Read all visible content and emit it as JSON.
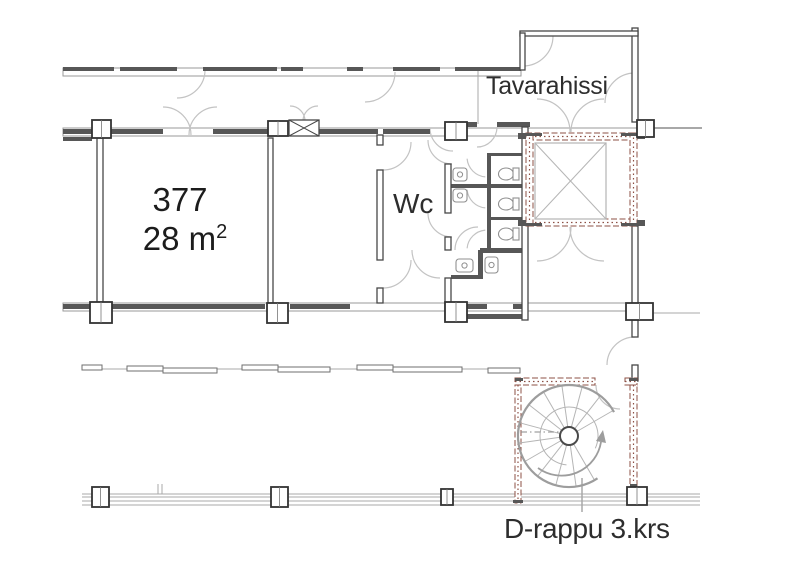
{
  "labels": {
    "tavarahissi": "Tavarahissi",
    "room_number": "377",
    "area_value": "28 m",
    "area_sup": "2",
    "wc": "Wc",
    "stair": "D-rappu 3.krs"
  },
  "colors": {
    "wall": "#474747",
    "dark": "#575757",
    "band": "#9a9a9a",
    "thin": "#a8a8a8",
    "box": "#6f6f6f",
    "door": "#c3c3c3",
    "fire": "#8d5045",
    "fixture": "#8f8f8f",
    "light": "#b5b5b5",
    "stairline": "#9d9d9d"
  },
  "plan": {
    "outline_bands": [
      [
        63,
        68,
        458,
        8
      ],
      [
        63,
        128,
        589,
        8
      ],
      [
        63,
        303,
        589,
        8
      ]
    ],
    "gray_lines": [
      [
        653,
        128,
        702,
        128,
        2
      ],
      [
        653,
        313,
        700,
        313,
        1
      ],
      [
        82,
        369,
        515,
        369,
        1
      ],
      [
        82,
        494,
        700,
        494,
        1
      ],
      [
        82,
        497,
        700,
        497,
        1
      ],
      [
        82,
        501,
        700,
        501,
        1
      ],
      [
        82,
        505,
        700,
        505,
        1
      ],
      [
        478,
        70,
        478,
        124,
        1
      ],
      [
        582,
        478,
        582,
        512,
        1.5
      ],
      [
        158,
        484,
        158,
        494,
        1
      ],
      [
        162,
        484,
        162,
        494,
        1
      ]
    ],
    "band_boxes": [
      [
        82,
        365,
        20,
        5
      ],
      [
        127,
        366,
        36,
        5
      ],
      [
        163,
        368,
        54,
        5
      ],
      [
        242,
        365,
        36,
        5
      ],
      [
        278,
        367,
        52,
        5
      ],
      [
        357,
        365,
        36,
        5
      ],
      [
        393,
        367,
        69,
        5
      ],
      [
        488,
        368,
        32,
        5
      ]
    ],
    "dark_segs": [
      [
        63,
        67,
        51,
        4
      ],
      [
        120,
        67,
        57,
        4
      ],
      [
        203,
        67,
        74,
        4
      ],
      [
        281,
        67,
        22,
        4
      ],
      [
        347,
        67,
        16,
        4
      ],
      [
        393,
        67,
        47,
        4
      ],
      [
        455,
        67,
        66,
        4
      ],
      [
        63,
        129,
        29,
        5
      ],
      [
        110,
        129,
        53,
        5
      ],
      [
        213,
        129,
        55,
        5
      ],
      [
        318,
        129,
        60,
        5
      ],
      [
        383,
        129,
        47,
        5
      ],
      [
        445,
        122,
        32,
        5
      ],
      [
        497,
        122,
        33,
        5
      ],
      [
        63,
        304,
        27,
        5
      ],
      [
        112,
        304,
        153,
        5
      ],
      [
        290,
        304,
        60,
        5
      ],
      [
        465,
        304,
        22,
        5
      ],
      [
        513,
        304,
        15,
        5
      ],
      [
        451,
        314,
        77,
        5
      ],
      [
        480,
        248,
        47,
        5
      ],
      [
        451,
        275,
        32,
        4
      ],
      [
        478,
        250,
        5,
        27
      ],
      [
        487,
        153,
        35,
        3
      ],
      [
        451,
        184,
        71,
        4
      ],
      [
        487,
        217,
        35,
        3
      ],
      [
        487,
        153,
        4,
        95
      ],
      [
        63,
        137,
        29,
        4
      ]
    ],
    "walls": [
      [
        97,
        138,
        6,
        164
      ],
      [
        268,
        138,
        5,
        165
      ],
      [
        377,
        135,
        6,
        10
      ],
      [
        377,
        170,
        6,
        90
      ],
      [
        377,
        288,
        6,
        15
      ],
      [
        445,
        124,
        6,
        16
      ],
      [
        445,
        164,
        6,
        49
      ],
      [
        445,
        237,
        6,
        13
      ],
      [
        445,
        278,
        6,
        42
      ],
      [
        522,
        127,
        6,
        193
      ],
      [
        632,
        28,
        6,
        94
      ],
      [
        632,
        226,
        6,
        78
      ],
      [
        632,
        320,
        6,
        17
      ],
      [
        632,
        365,
        6,
        16
      ],
      [
        520,
        31,
        118,
        5
      ],
      [
        520,
        33,
        5,
        37
      ]
    ],
    "fire_walls": [
      [
        526,
        133,
        111,
        7
      ],
      [
        526,
        219,
        111,
        7
      ],
      [
        526,
        133,
        7,
        93
      ],
      [
        630,
        133,
        7,
        93
      ],
      [
        515,
        378,
        80,
        7
      ],
      [
        625,
        378,
        12,
        7
      ],
      [
        515,
        385,
        6,
        118
      ],
      [
        630,
        385,
        7,
        102
      ]
    ],
    "fire_tabs": [
      [
        526,
        133,
        16,
        3
      ],
      [
        621,
        133,
        16,
        3
      ],
      [
        526,
        223,
        16,
        3
      ],
      [
        621,
        223,
        16,
        3
      ],
      [
        518,
        133,
        8,
        6
      ],
      [
        518,
        220,
        8,
        6
      ],
      [
        637,
        133,
        8,
        6
      ],
      [
        637,
        220,
        8,
        6
      ],
      [
        515,
        378,
        8,
        3
      ],
      [
        629,
        378,
        8,
        3
      ],
      [
        513,
        500,
        10,
        3
      ],
      [
        630,
        484,
        7,
        3
      ]
    ],
    "columns": [
      [
        92,
        120,
        19,
        18
      ],
      [
        268,
        121,
        20,
        15
      ],
      [
        445,
        122,
        22,
        18
      ],
      [
        637,
        120,
        17,
        17
      ],
      [
        90,
        302,
        22,
        21
      ],
      [
        267,
        303,
        21,
        20
      ],
      [
        445,
        302,
        22,
        20
      ],
      [
        626,
        303,
        27,
        17
      ],
      [
        92,
        487,
        17,
        20
      ],
      [
        271,
        487,
        17,
        20
      ],
      [
        627,
        487,
        20,
        18
      ],
      [
        441,
        489,
        12,
        16
      ]
    ],
    "xboxes": [
      [
        289,
        120,
        30,
        16
      ]
    ],
    "car": [
      535,
      143,
      71,
      76
    ],
    "doors": [
      [
        177,
        70,
        28,
        0,
        90
      ],
      [
        365,
        72,
        30,
        0,
        90
      ],
      [
        523,
        36,
        30,
        0,
        90
      ],
      [
        635,
        103,
        30,
        180,
        270
      ],
      [
        163,
        135,
        28,
        270,
        360
      ],
      [
        217,
        135,
        28,
        180,
        270
      ],
      [
        290,
        121,
        15,
        270,
        360
      ],
      [
        318,
        121,
        15,
        180,
        270
      ],
      [
        537,
        132,
        33,
        270,
        360
      ],
      [
        604,
        132,
        33,
        180,
        270
      ],
      [
        537,
        227,
        34,
        0,
        90
      ],
      [
        604,
        227,
        34,
        90,
        180
      ],
      [
        383,
        142,
        28,
        0,
        90
      ],
      [
        383,
        260,
        28,
        0,
        90
      ],
      [
        453,
        128,
        23,
        90,
        180
      ],
      [
        477,
        127,
        20,
        0,
        90
      ],
      [
        635,
        365,
        28,
        180,
        270
      ],
      [
        620,
        385,
        24,
        90,
        180
      ],
      [
        487,
        157,
        20,
        95,
        175
      ],
      [
        487,
        188,
        20,
        95,
        175
      ],
      [
        487,
        250,
        20,
        185,
        265
      ],
      [
        452,
        140,
        24,
        90,
        180
      ],
      [
        452,
        213,
        24,
        90,
        180
      ],
      [
        440,
        250,
        28,
        90,
        180
      ],
      [
        478,
        250,
        23,
        180,
        270
      ]
    ],
    "toilets": [
      [
        506,
        174
      ],
      [
        506,
        204
      ],
      [
        506,
        234
      ]
    ],
    "basins": [
      [
        453,
        168,
        14,
        13
      ],
      [
        453,
        189,
        14,
        13
      ],
      [
        456,
        259,
        17,
        13
      ],
      [
        485,
        257,
        13,
        16
      ]
    ],
    "stair": {
      "cx": 569,
      "cy": 436,
      "r_outer": 51,
      "r_mid": 29,
      "r_inner": 9,
      "outer_a0": 56,
      "outer_a1": 332,
      "mid_a0": 95,
      "mid_a1": 385,
      "treads": [
        60,
        82,
        105,
        128,
        150,
        172,
        195,
        218,
        240,
        262,
        285,
        308,
        330
      ],
      "dash_line": [
        521,
        432,
        562,
        432
      ],
      "arrow_path": "M538,468 A40,40 0 0 0 601,442",
      "arrow_head": "603,430 606,443 596,441"
    }
  }
}
